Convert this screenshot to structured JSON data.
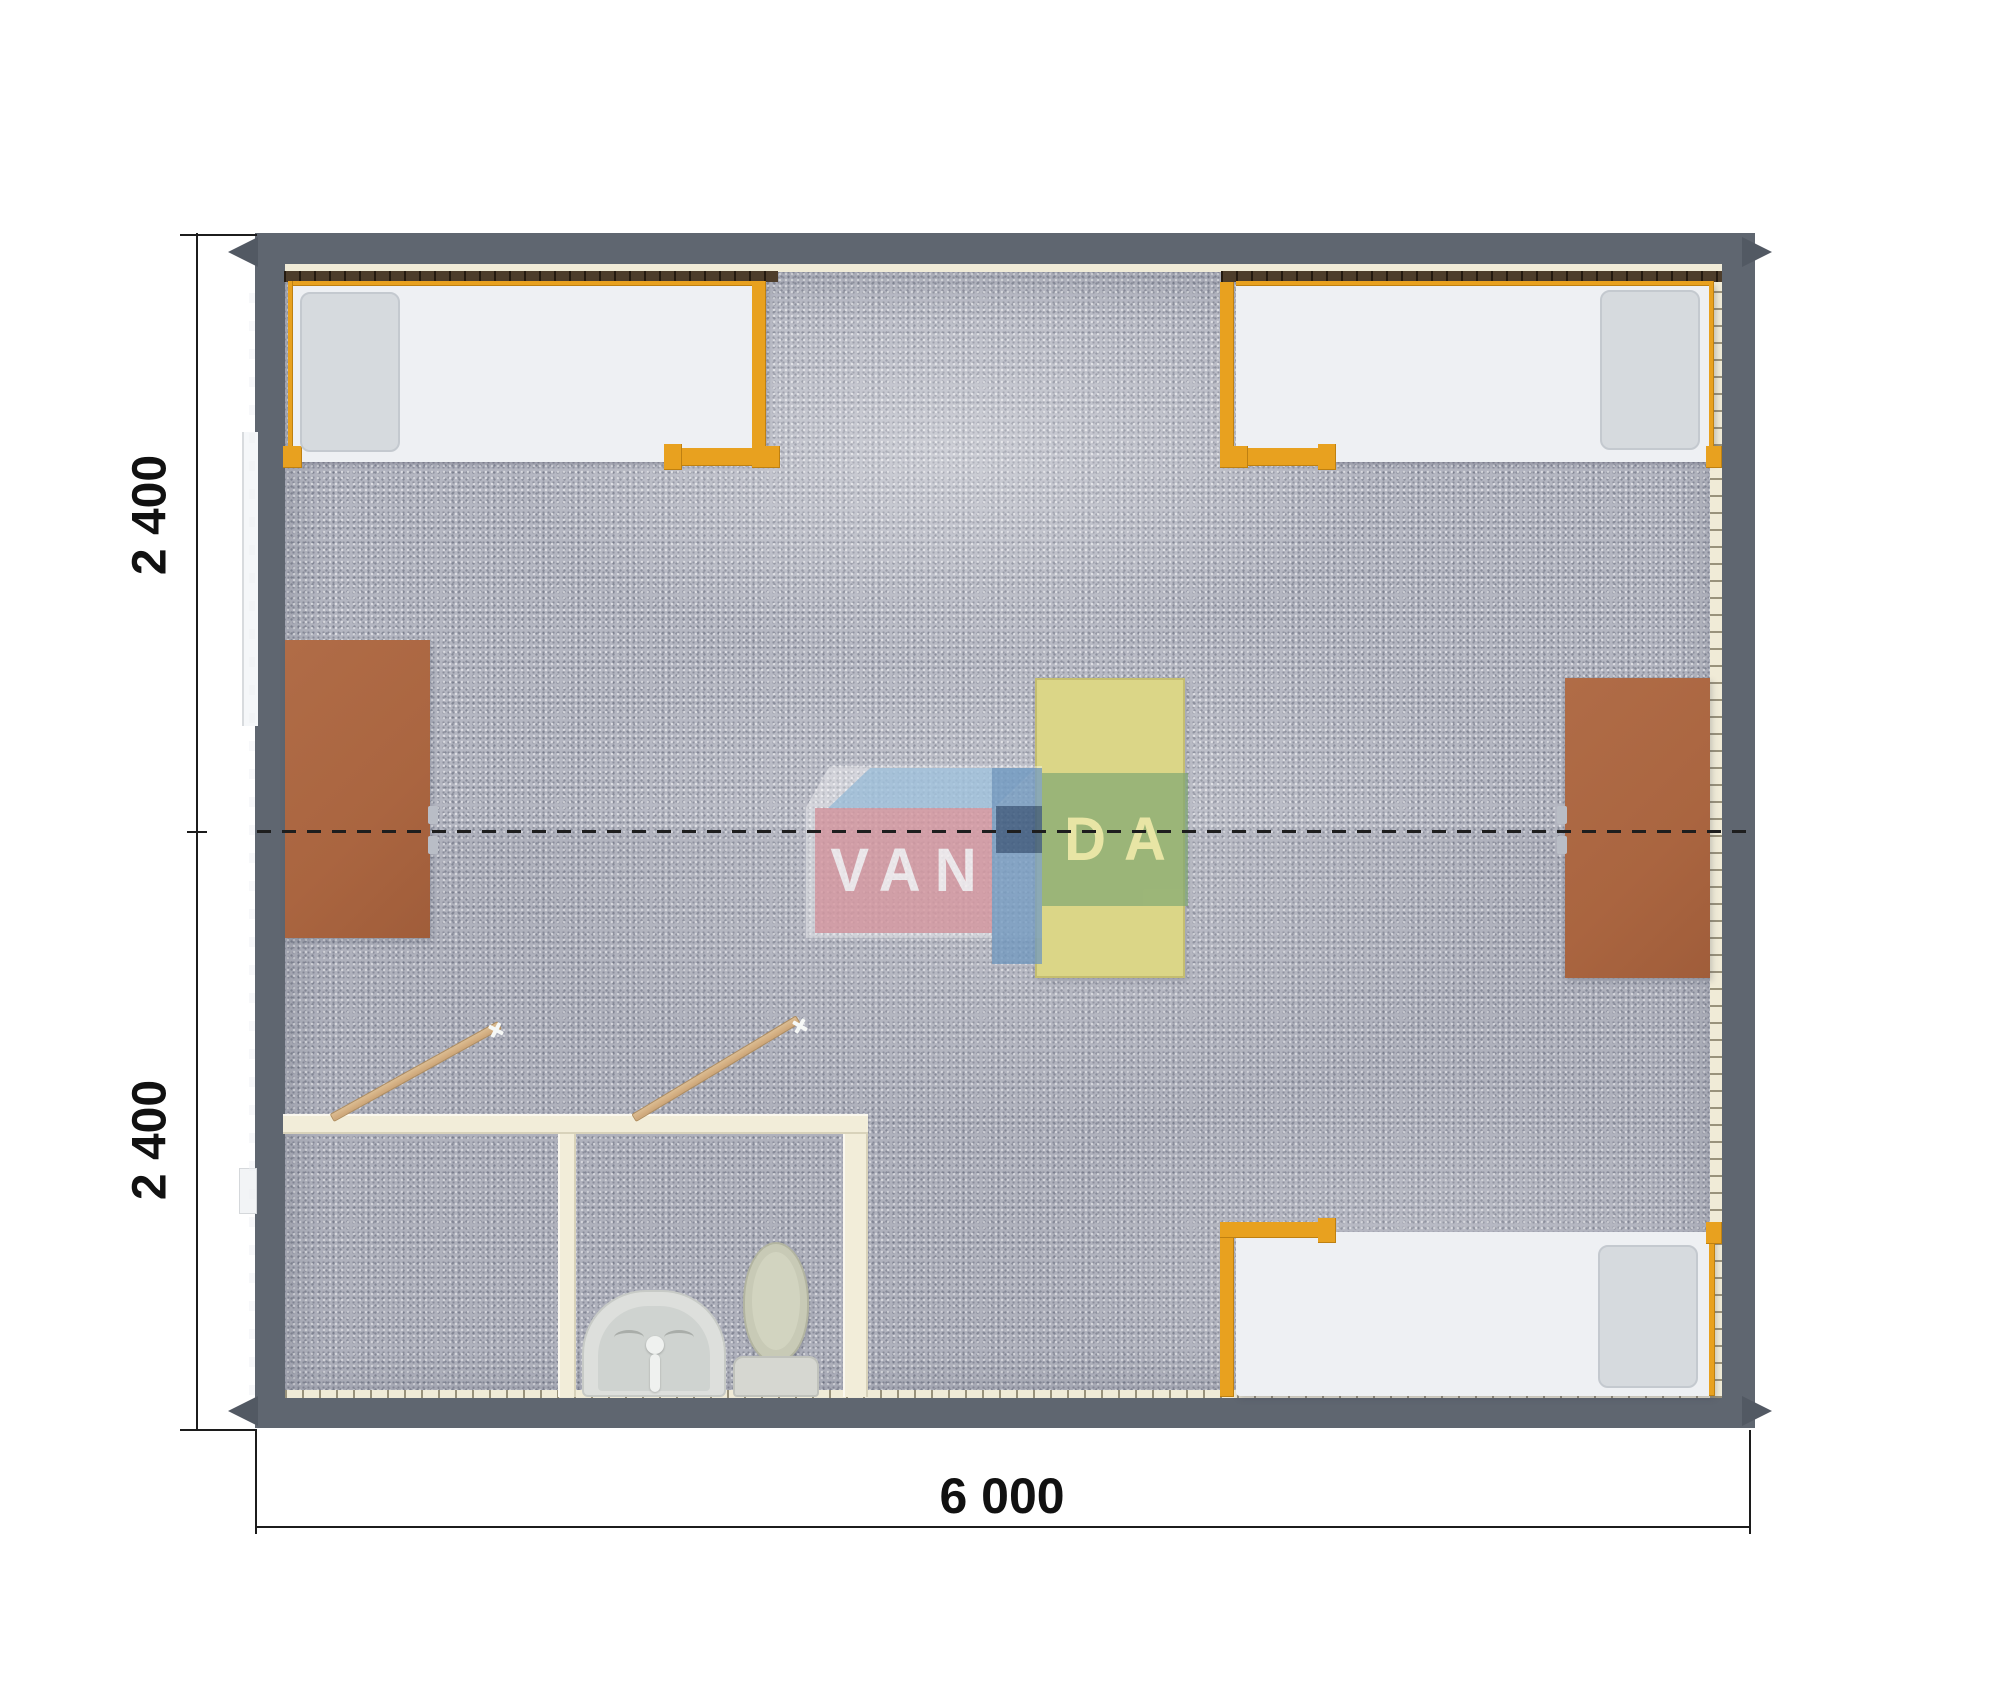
{
  "title": "VANDA modular house floor plan",
  "dimension_labels": {
    "bottom_width": "6 000",
    "left_height_top": "2 400",
    "left_height_bottom": "2 400"
  },
  "watermark": {
    "text_left": "VAN",
    "text_right": "DA",
    "full_name": "VANDA"
  },
  "colors": {
    "outer_wall": "#5f6670",
    "floor_carpet": "#b4b6c1",
    "bed_frame_orange": "#e8a11f",
    "bed_mattress": "#eef0f3",
    "desk_brown": "#ab6641",
    "table_yellow": "#dbd687",
    "interior_wall_cream": "#f2edd9",
    "logo_pink": "#d6959d",
    "logo_green": "#7da672",
    "logo_blue": "#6e97bf",
    "logo_navy": "#3e5c80",
    "dimension_color": "#1c1c1c",
    "door_wood": "#d3ab7d"
  },
  "furniture": {
    "beds": [
      "bed-top-left",
      "bed-top-right",
      "bed-bottom-right"
    ],
    "desks": [
      "desk-left",
      "desk-right"
    ],
    "table": "table-center",
    "bathroom_fixtures": [
      "washbasin",
      "toilet"
    ],
    "doors": [
      "door-left-room",
      "door-right-room"
    ]
  }
}
